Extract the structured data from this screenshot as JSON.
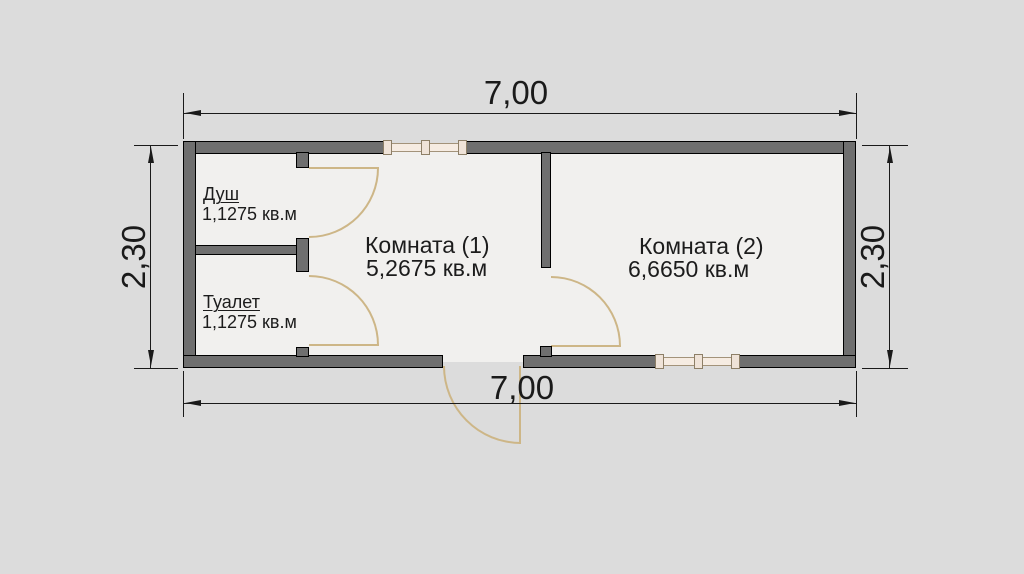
{
  "title": "Floor plan 7.00 x 2.30 with two rooms, shower and toilet",
  "dimensions": {
    "top": "7,00",
    "bottom": "7,00",
    "left": "2,30",
    "right": "2,30"
  },
  "rooms": {
    "dush": {
      "name": "Душ",
      "area": "1,1275 кв.м"
    },
    "tualet": {
      "name": "Туалет",
      "area": "1,1275 кв.м"
    },
    "room1": {
      "name": "Комната (1)",
      "area": "5,2675 кв.м"
    },
    "room2": {
      "name": "Комната (2)",
      "area": "6,6650 кв.м"
    }
  },
  "features": {
    "windows": [
      "top-wall-window",
      "bottom-wall-window"
    ],
    "doors": [
      "dush-door",
      "tualet-door",
      "room-divider-door",
      "entrance-door"
    ]
  },
  "colors": {
    "background": "#dcdcdc",
    "floor": "#f1f0ee",
    "wall_fill": "#6f6f6f",
    "wall_outline": "#000000",
    "door_swing": "#cdb687",
    "window_fill": "#f6ece2",
    "dimension_ink": "#1a1a1a"
  }
}
